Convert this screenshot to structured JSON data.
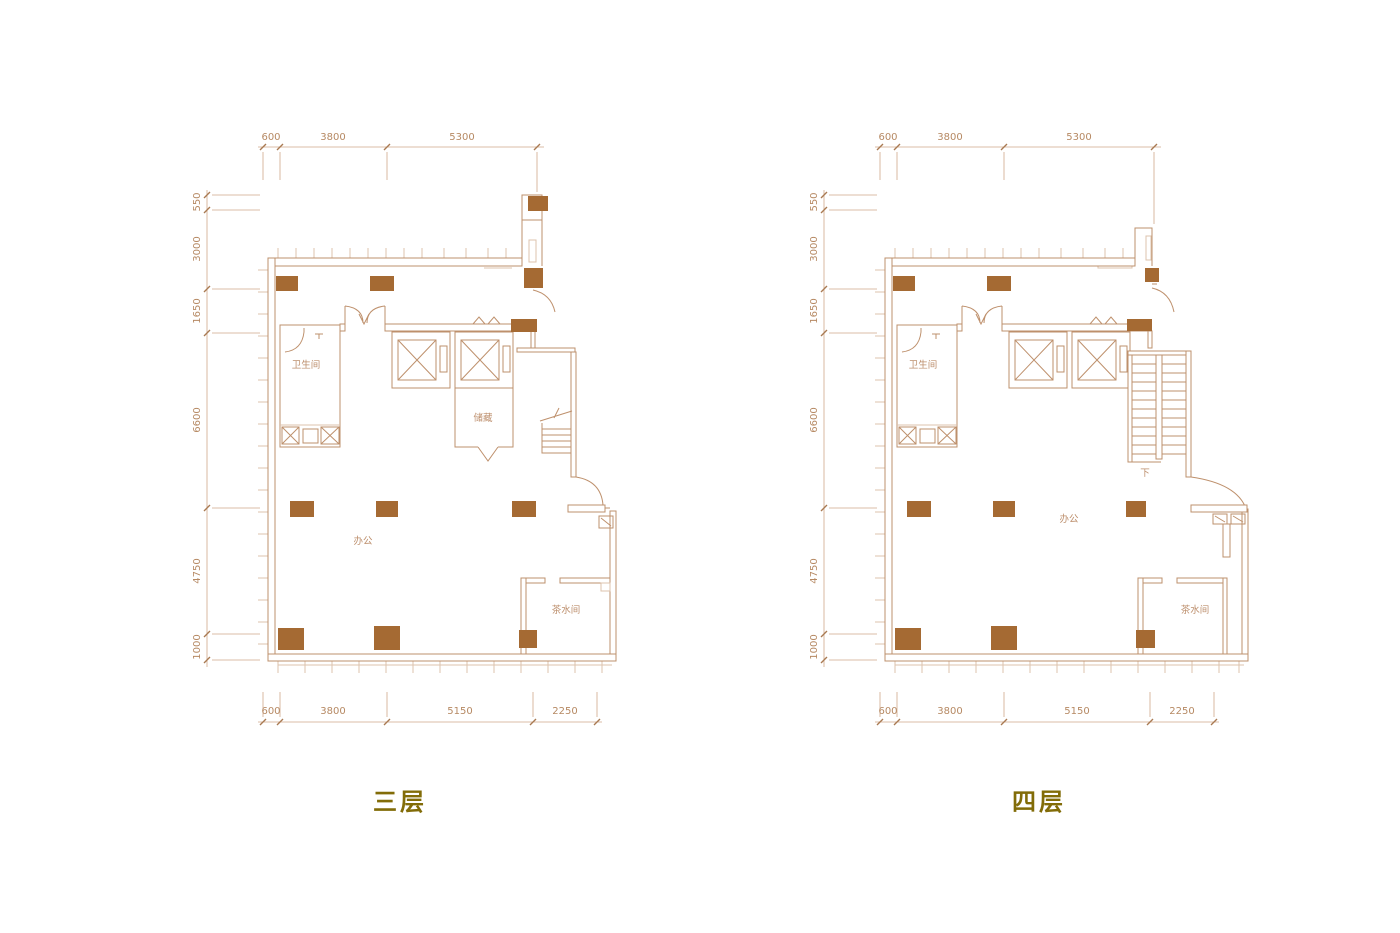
{
  "colors": {
    "background": "#ffffff",
    "wall": "#be906c",
    "wall_light": "#dcc3ad",
    "column_fill": "#a56a33",
    "dimension_text": "#b68963",
    "room_label": "#bd8f6d",
    "floor_label": "#826c08"
  },
  "plans": [
    {
      "floor_label": "三层",
      "dims_top": [
        "600",
        "3800",
        "5300"
      ],
      "dims_left": [
        "550",
        "3000",
        "1650",
        "6600",
        "4750",
        "1000"
      ],
      "dims_bottom": [
        "600",
        "3800",
        "5150",
        "2250"
      ],
      "rooms": {
        "bathroom": "卫生间",
        "storage": "储藏",
        "office": "办公",
        "tea_room": "茶水间"
      }
    },
    {
      "floor_label": "四层",
      "dims_top": [
        "600",
        "3800",
        "5300"
      ],
      "dims_left": [
        "550",
        "3000",
        "1650",
        "6600",
        "4750",
        "1000"
      ],
      "dims_bottom": [
        "600",
        "3800",
        "5150",
        "2250"
      ],
      "rooms": {
        "bathroom": "卫生间",
        "office": "办公",
        "tea_room": "茶水间",
        "stair_down": "下"
      }
    }
  ]
}
